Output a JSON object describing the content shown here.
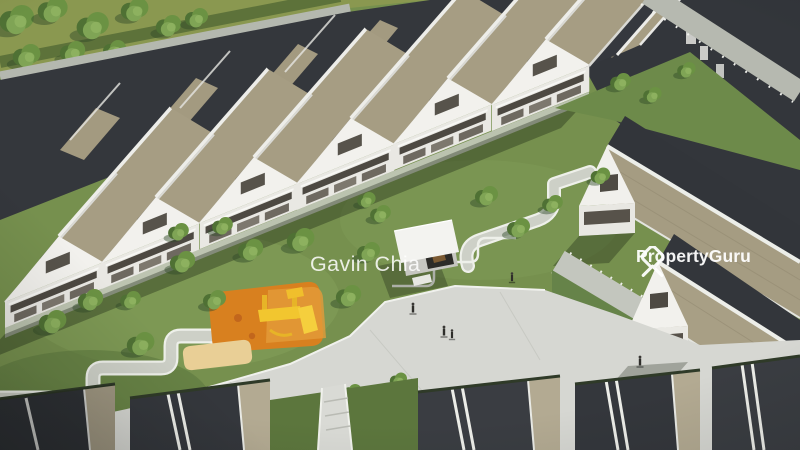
{
  "scene": {
    "description": "Aerial 3D architectural render of a terrace-house development with a central linear park, orange playground, white pavilion, walking paths and plaza",
    "elements": [
      "terrace-house-rows",
      "central-park",
      "playground",
      "pavilion",
      "plaza",
      "walking-paths",
      "trees",
      "roads",
      "pedestrians"
    ]
  },
  "watermarks": {
    "agent_name": "Gavin Chia",
    "brand": "PropertyGuru"
  },
  "colors": {
    "roof_dark": "#34373c",
    "roof_tan": "#a89f85",
    "wall_white": "#f2f1ed",
    "grass": "#76904e",
    "pavement": "#d6d7d2",
    "playground_orange": "#d8801f",
    "play_equipment_yellow": "#f2c62f",
    "watermark": "#ffffff"
  }
}
